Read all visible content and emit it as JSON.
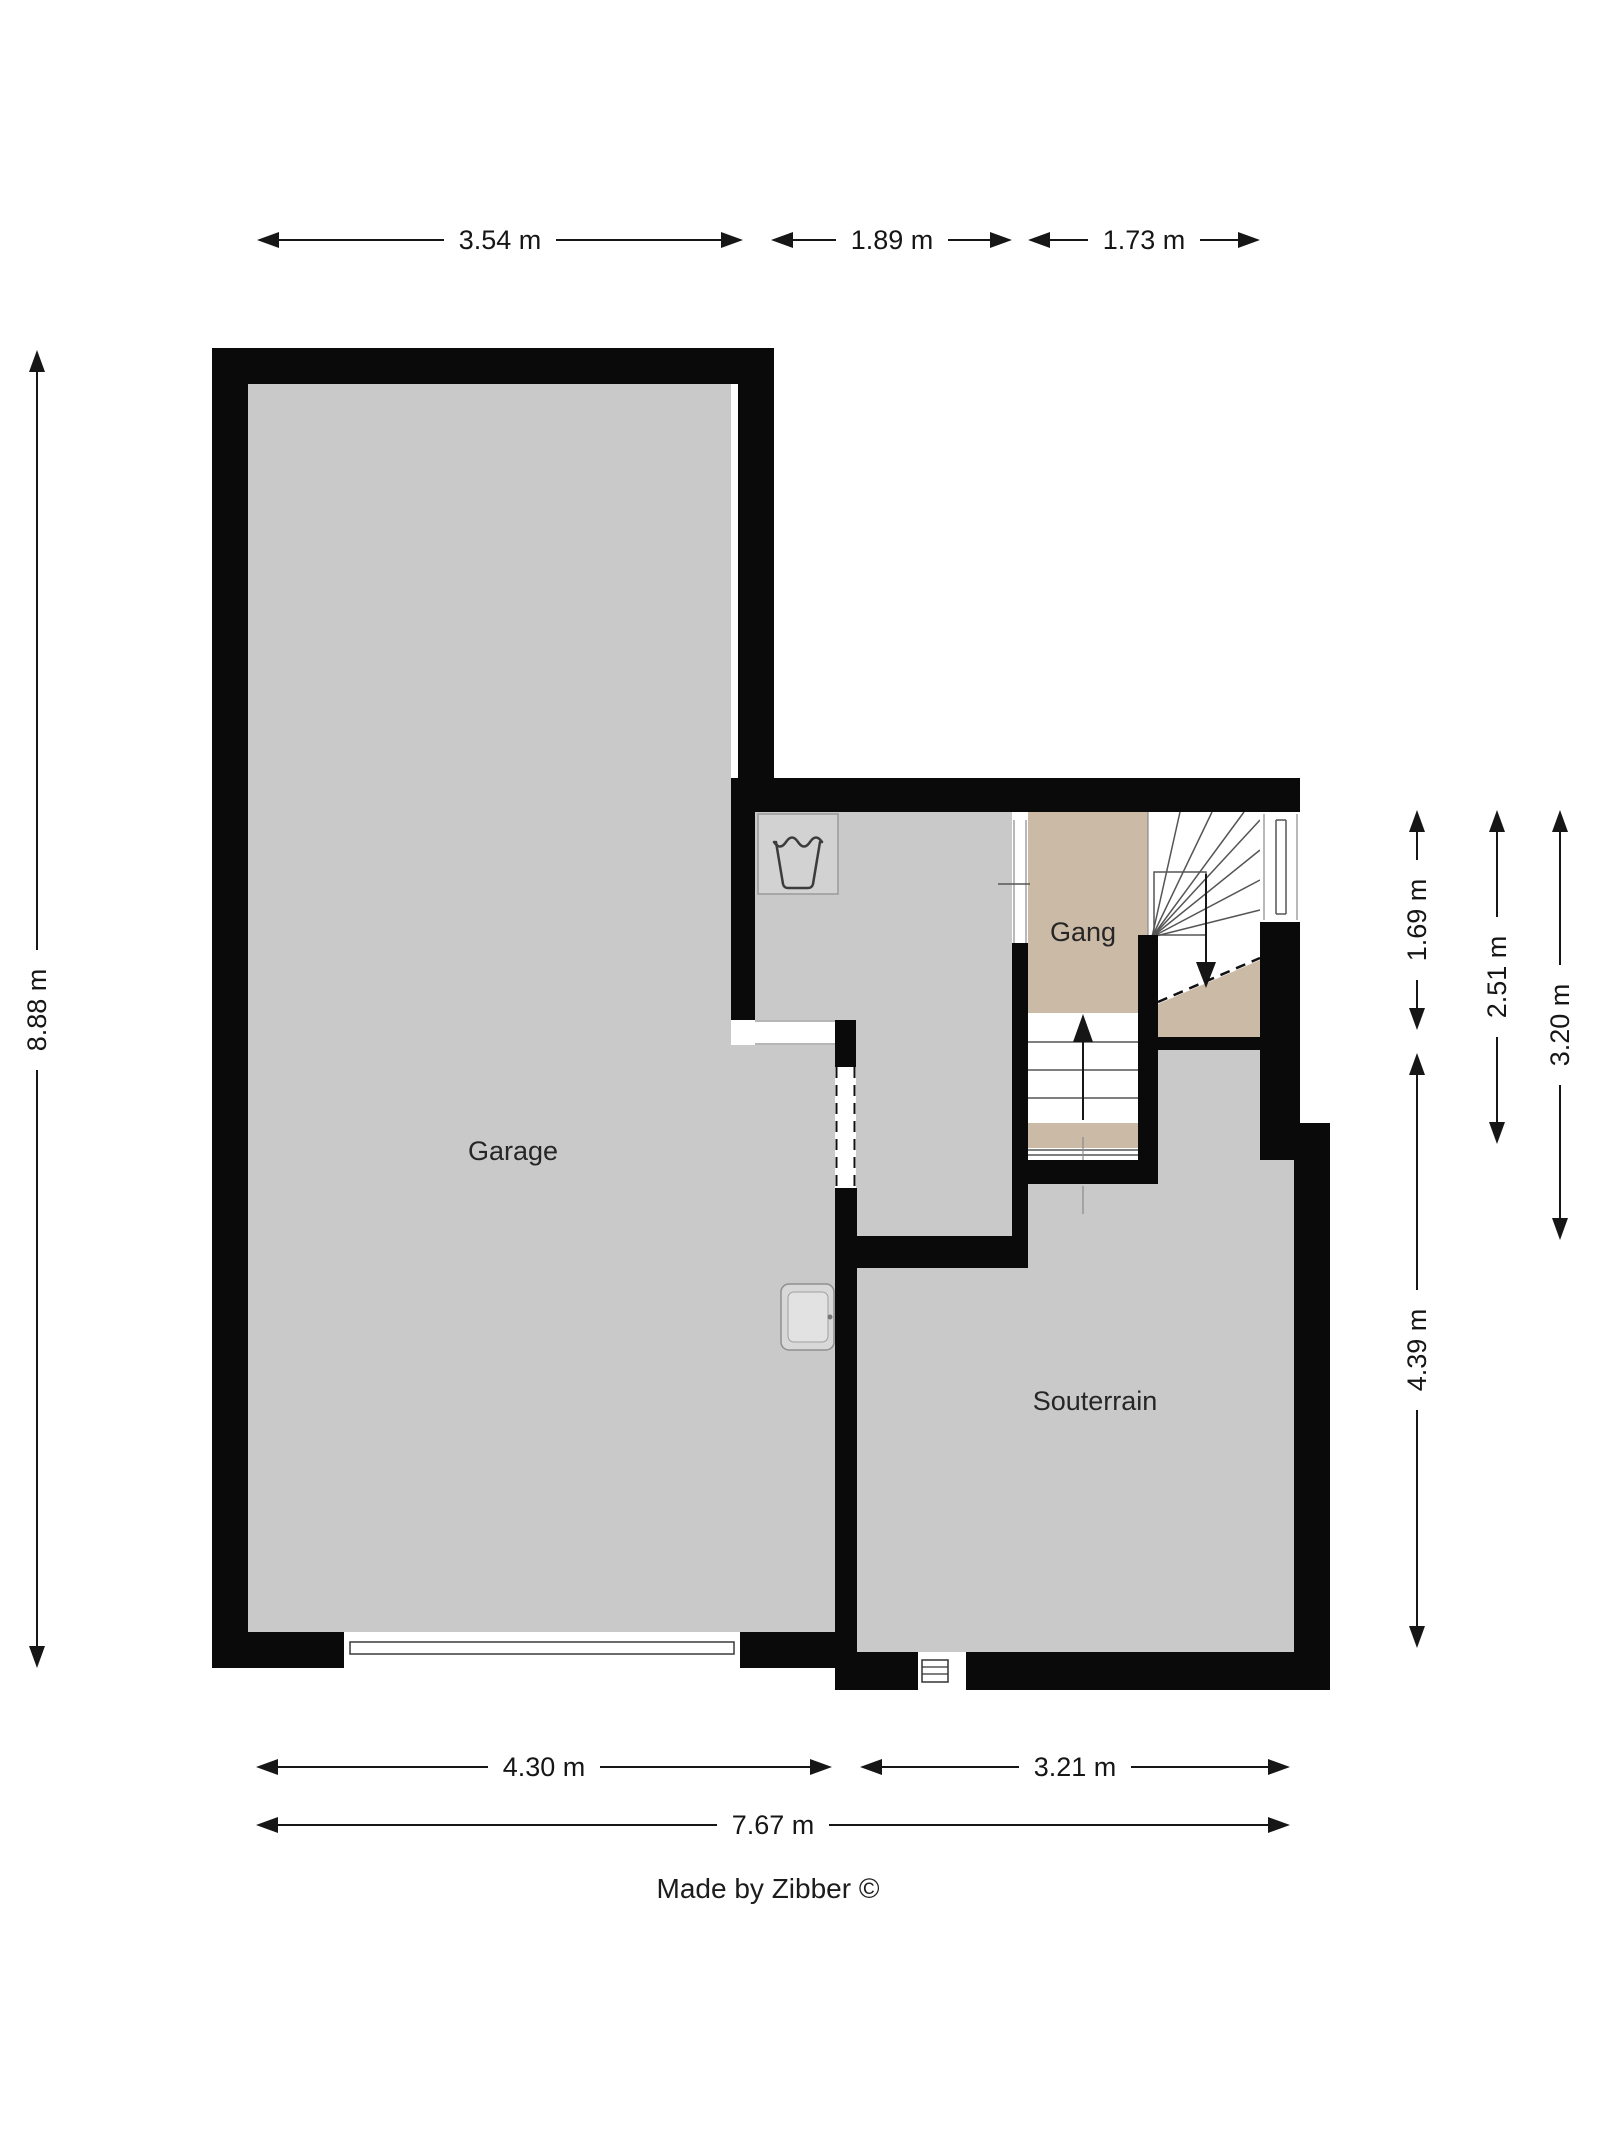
{
  "footer": {
    "credit": "Made by Zibber ©"
  },
  "rooms": [
    {
      "name": "garage",
      "label": "Garage"
    },
    {
      "name": "gang",
      "label": "Gang"
    },
    {
      "name": "souterrain",
      "label": "Souterrain"
    }
  ],
  "dimensions": {
    "top": [
      {
        "label": "3.54 m"
      },
      {
        "label": "1.89 m"
      },
      {
        "label": "1.73 m"
      }
    ],
    "left": [
      {
        "label": "8.88 m"
      }
    ],
    "right": [
      {
        "label": "1.69 m"
      },
      {
        "label": "2.51 m"
      },
      {
        "label": "3.20 m"
      },
      {
        "label": "4.39 m"
      }
    ],
    "bottom": [
      {
        "label": "4.30 m"
      },
      {
        "label": "3.21 m"
      },
      {
        "label": "7.67 m"
      }
    ]
  },
  "icons": [
    {
      "name": "washing-machine-icon"
    },
    {
      "name": "sink-icon"
    },
    {
      "name": "window-icon"
    },
    {
      "name": "basement-window-icon"
    },
    {
      "name": "garage-door"
    },
    {
      "name": "stairs-up-arrow-icon"
    },
    {
      "name": "stairs-down-arrow-icon"
    }
  ],
  "colors": {
    "wall": "#0a0a0a",
    "floor": "#c9c9c9",
    "hall_floor": "#cbbaa6",
    "background": "#ffffff",
    "dimension": "#161616",
    "label": "#262626"
  }
}
